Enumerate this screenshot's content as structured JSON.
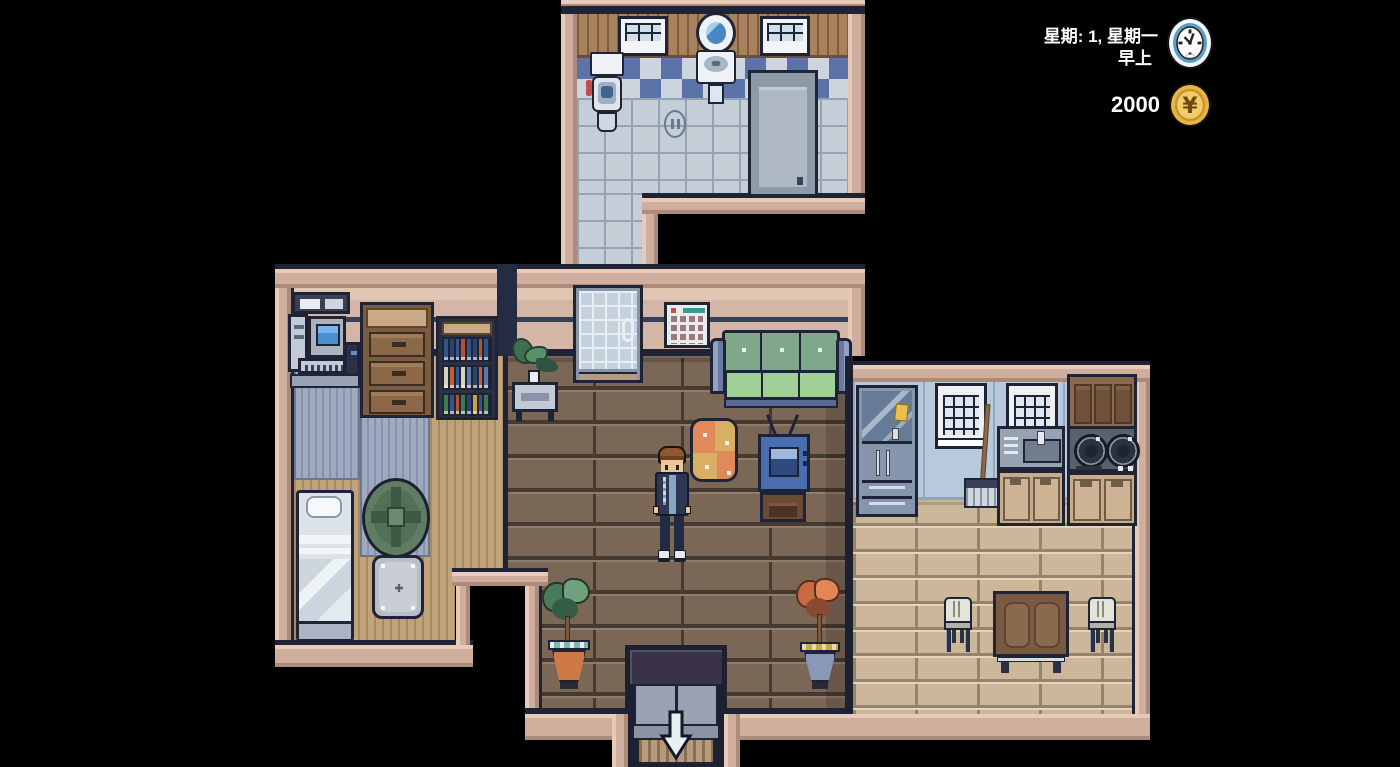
{
  "hud": {
    "week_label": "星期: 1, 星期一",
    "time_of_day": "早上",
    "money": "2000",
    "currency_symbol": "¥",
    "icons": {
      "clock": "clock-icon",
      "coin": "yen-coin-icon"
    }
  },
  "colors": {
    "background": "#000000",
    "wall_trim": "#cfae9d",
    "hud_text": "#ffffff",
    "clock_ring": "#5a9ec8",
    "coin_gold": "#e8b648",
    "sofa_green": "#9fd096",
    "living_floor": "#7b6756",
    "kitchen_floor": "#cdb79a",
    "book_spines": {
      "row1": [
        "#35558a",
        "#2a4470",
        "#35558a",
        "#b8502f",
        "#35558a",
        "#2a4470",
        "#b8502f",
        "#35558a"
      ],
      "row2": [
        "#d8d2c4",
        "#c06030",
        "#35558a",
        "#d8d2c4",
        "#5a78a8",
        "#2a4470",
        "#c06030",
        "#5a78a8"
      ],
      "row3": [
        "#3f7a4f",
        "#35558a",
        "#b8502f",
        "#3f7a4f",
        "#2a4470",
        "#d0a040",
        "#35558a",
        "#3f7a4f"
      ]
    }
  }
}
